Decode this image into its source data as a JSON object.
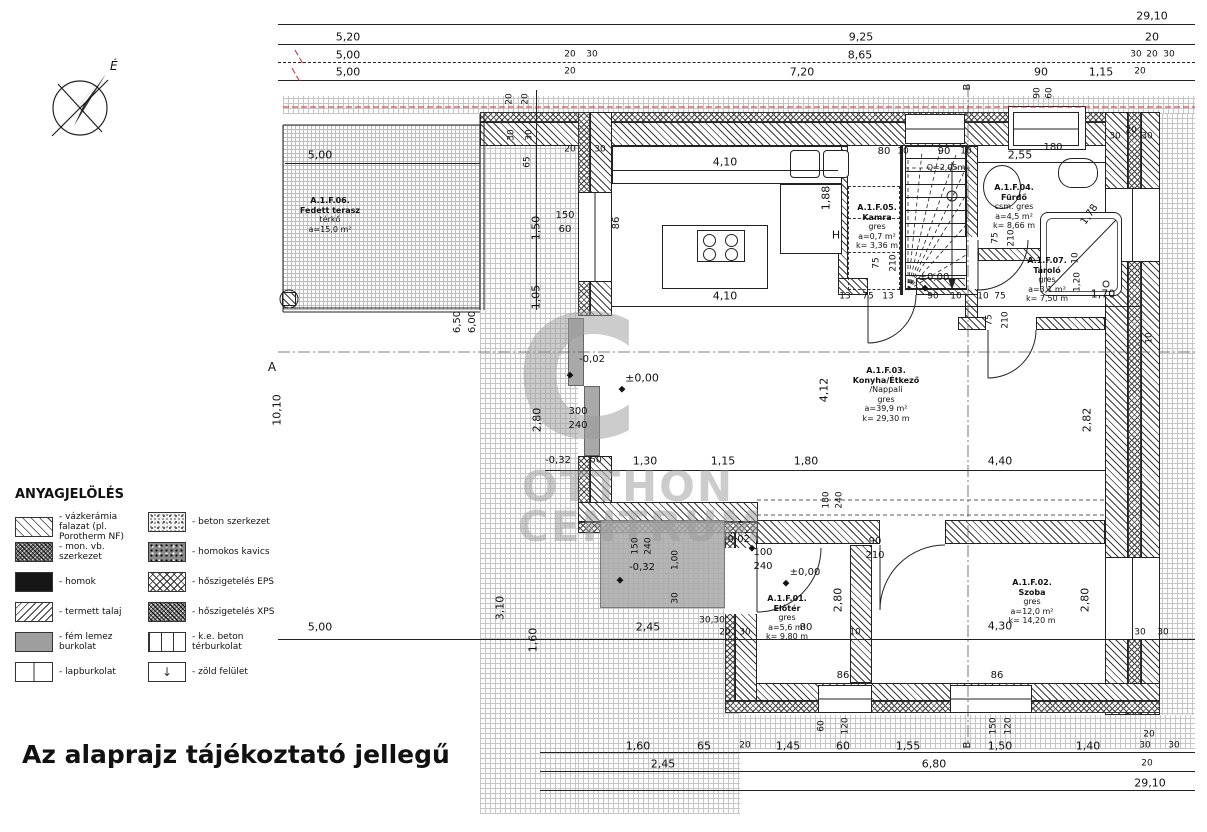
{
  "title": "Az alaprajz tájékoztató jellegű",
  "compass_label": "É",
  "watermark": {
    "big": "C",
    "line1": "OTTHON",
    "line2": "CENTRUM"
  },
  "legend": {
    "title": "ANYAGJELÖLÉS",
    "zold_symbol": "↓",
    "items_left": [
      {
        "pattern": "sw-vazkeramia",
        "label": "- vázkerámia falazat (pl. Porotherm NF)"
      },
      {
        "pattern": "sw-monvb",
        "label": "- mon. vb. szerkezet"
      },
      {
        "pattern": "sw-homok",
        "label": "- homok"
      },
      {
        "pattern": "sw-termett",
        "label": "- termett talaj"
      },
      {
        "pattern": "sw-femlemez",
        "label": "- fém lemez burkolat"
      },
      {
        "pattern": "sw-lap",
        "label": "- lapburkolat"
      }
    ],
    "items_right": [
      {
        "pattern": "sw-beton",
        "label": "- beton szerkezet"
      },
      {
        "pattern": "sw-kavics",
        "label": "- homokos kavics"
      },
      {
        "pattern": "sw-eps",
        "label": "- hőszigetelés EPS"
      },
      {
        "pattern": "sw-xps",
        "label": "- hőszigetelés XPS"
      },
      {
        "pattern": "sw-kebeton",
        "label": "- k.e. beton térburkolat"
      },
      {
        "pattern": "sw-zold",
        "label": "- zöld felület"
      }
    ]
  },
  "rooms": [
    {
      "id": "A1F06",
      "x": 330,
      "y": 196,
      "lines": [
        "A.1.F.06.",
        "Fedett terasz",
        "térkő",
        "a=15,0 m²"
      ]
    },
    {
      "id": "A1F05",
      "x": 877,
      "y": 203,
      "lines": [
        "A.1.F.05.",
        "Kamra",
        "gres",
        "a=0,7 m²",
        "k= 3,36 m"
      ]
    },
    {
      "id": "A1F03",
      "x": 886,
      "y": 366,
      "lines": [
        "A.1.F.03.",
        "Konyha/Étkező",
        "/Nappali",
        "gres",
        "a=39,9 m²",
        "k= 29,30 m"
      ]
    },
    {
      "id": "A1F04",
      "x": 1014,
      "y": 183,
      "lines": [
        "A.1.F.04.",
        "Fürdő",
        "csm. gres",
        "a=4,5 m²",
        "k= 8,66 m"
      ]
    },
    {
      "id": "A1F07",
      "x": 1047,
      "y": 256,
      "lines": [
        "A.1.F.07.",
        "Tároló",
        "gres",
        "a=3,1 m²",
        "k= 7,50 m"
      ]
    },
    {
      "id": "A1F01",
      "x": 787,
      "y": 594,
      "lines": [
        "A.1.F.01.",
        "Előtér",
        "gres",
        "a=5,6 m²",
        "k= 9,80 m"
      ]
    },
    {
      "id": "A1F02",
      "x": 1032,
      "y": 578,
      "lines": [
        "A.1.F.02.",
        "Szoba",
        "gres",
        "a=12,0 m²",
        "k= 14,20 m"
      ]
    }
  ],
  "annotations": [
    {
      "t": "29,10",
      "x": 1152,
      "y": 16
    },
    {
      "t": "5,20",
      "x": 348,
      "y": 37
    },
    {
      "t": "9,25",
      "x": 861,
      "y": 37
    },
    {
      "t": "20",
      "x": 1152,
      "y": 37
    },
    {
      "t": "5,00",
      "x": 348,
      "y": 55
    },
    {
      "t": "20",
      "x": 570,
      "y": 55,
      "s": 9
    },
    {
      "t": "30",
      "x": 592,
      "y": 55,
      "s": 9
    },
    {
      "t": "8,65",
      "x": 860,
      "y": 55
    },
    {
      "t": "30",
      "x": 1136,
      "y": 55,
      "s": 9
    },
    {
      "t": "20",
      "x": 1152,
      "y": 55,
      "s": 9
    },
    {
      "t": "30",
      "x": 1169,
      "y": 55,
      "s": 9
    },
    {
      "t": "5,00",
      "x": 348,
      "y": 72
    },
    {
      "t": "20",
      "x": 570,
      "y": 72,
      "s": 9
    },
    {
      "t": "7,20",
      "x": 802,
      "y": 72
    },
    {
      "t": "90",
      "x": 1041,
      "y": 72
    },
    {
      "t": "1,15",
      "x": 1101,
      "y": 72
    },
    {
      "t": "20",
      "x": 1140,
      "y": 72,
      "s": 9
    },
    {
      "t": "5,00",
      "x": 320,
      "y": 155
    },
    {
      "t": "4,10",
      "x": 725,
      "y": 162
    },
    {
      "t": "4,10",
      "x": 725,
      "y": 296
    },
    {
      "t": "86",
      "x": 617,
      "y": 223,
      "r": -90,
      "s": 10
    },
    {
      "t": "1,88",
      "x": 826,
      "y": 198,
      "r": -90
    },
    {
      "t": "H",
      "x": 836,
      "y": 235,
      "s": 11
    },
    {
      "t": "150",
      "x": 565,
      "y": 216,
      "s": 10
    },
    {
      "t": "60",
      "x": 565,
      "y": 230,
      "s": 10
    },
    {
      "t": "80",
      "x": 884,
      "y": 152,
      "s": 10
    },
    {
      "t": "10",
      "x": 903,
      "y": 152,
      "s": 9
    },
    {
      "t": "90",
      "x": 944,
      "y": 152,
      "s": 10
    },
    {
      "t": "10",
      "x": 966,
      "y": 152,
      "s": 9
    },
    {
      "t": "Q=2,05m",
      "x": 946,
      "y": 168,
      "s": 8
    },
    {
      "t": "75",
      "x": 877,
      "y": 263,
      "r": -90,
      "s": 9
    },
    {
      "t": "210",
      "x": 894,
      "y": 263,
      "r": -90,
      "s": 9
    },
    {
      "t": "±0,00",
      "x": 934,
      "y": 278,
      "s": 10,
      "n": "level-marker"
    },
    {
      "t": "2,55",
      "x": 1020,
      "y": 155
    },
    {
      "t": "180",
      "x": 1053,
      "y": 148,
      "s": 10
    },
    {
      "t": "90",
      "x": 1038,
      "y": 93,
      "r": -90,
      "s": 9
    },
    {
      "t": "60",
      "x": 1050,
      "y": 93,
      "r": -90,
      "s": 9
    },
    {
      "t": "75",
      "x": 996,
      "y": 238,
      "r": -90,
      "s": 9
    },
    {
      "t": "210",
      "x": 1012,
      "y": 238,
      "r": -90,
      "s": 9
    },
    {
      "t": "1,78",
      "x": 1090,
      "y": 215,
      "r": -55,
      "s": 10
    },
    {
      "t": "30",
      "x": 1115,
      "y": 137,
      "s": 9
    },
    {
      "t": "20",
      "x": 1131,
      "y": 131,
      "s": 9
    },
    {
      "t": "30",
      "x": 1147,
      "y": 137,
      "s": 9
    },
    {
      "t": "75",
      "x": 990,
      "y": 320,
      "r": -90,
      "s": 9
    },
    {
      "t": "210",
      "x": 1006,
      "y": 320,
      "r": -90,
      "s": 9
    },
    {
      "t": "1,70",
      "x": 1103,
      "y": 294
    },
    {
      "t": "10",
      "x": 1076,
      "y": 258,
      "r": -90,
      "s": 9
    },
    {
      "t": "1,20",
      "x": 1078,
      "y": 282,
      "r": -90,
      "s": 9
    },
    {
      "t": "10",
      "x": 1150,
      "y": 338,
      "r": -90,
      "s": 9
    },
    {
      "t": "13",
      "x": 845,
      "y": 297,
      "s": 9
    },
    {
      "t": "75",
      "x": 868,
      "y": 297,
      "s": 9
    },
    {
      "t": "13",
      "x": 888,
      "y": 297,
      "s": 9
    },
    {
      "t": "90",
      "x": 933,
      "y": 297,
      "s": 9
    },
    {
      "t": "10",
      "x": 956,
      "y": 297,
      "s": 9
    },
    {
      "t": "10",
      "x": 983,
      "y": 297,
      "s": 9
    },
    {
      "t": "75",
      "x": 1000,
      "y": 297,
      "s": 9
    },
    {
      "t": "20",
      "x": 510,
      "y": 99,
      "r": -90,
      "s": 9
    },
    {
      "t": "20",
      "x": 526,
      "y": 99,
      "r": -90,
      "s": 9
    },
    {
      "t": "30",
      "x": 512,
      "y": 135,
      "r": -90,
      "s": 9
    },
    {
      "t": "30",
      "x": 530,
      "y": 135,
      "r": -90,
      "s": 9
    },
    {
      "t": "20",
      "x": 570,
      "y": 150,
      "s": 9
    },
    {
      "t": "30",
      "x": 600,
      "y": 150,
      "s": 9
    },
    {
      "t": "65",
      "x": 528,
      "y": 162,
      "r": -90,
      "s": 9
    },
    {
      "t": "1,50",
      "x": 536,
      "y": 228,
      "r": -90
    },
    {
      "t": "1,05",
      "x": 536,
      "y": 297,
      "r": -90
    },
    {
      "t": "10,10",
      "x": 277,
      "y": 410,
      "r": -90
    },
    {
      "t": "6,50",
      "x": 458,
      "y": 322,
      "r": -90,
      "s": 10
    },
    {
      "t": "6,00",
      "x": 473,
      "y": 322,
      "r": -90,
      "s": 10
    },
    {
      "t": "2,80",
      "x": 537,
      "y": 420,
      "r": -90
    },
    {
      "t": "-0,02",
      "x": 592,
      "y": 360,
      "s": 10,
      "n": "level-marker"
    },
    {
      "t": "±0,00",
      "x": 642,
      "y": 378,
      "s": 11,
      "n": "level-marker"
    },
    {
      "t": "300",
      "x": 578,
      "y": 412,
      "s": 10
    },
    {
      "t": "240",
      "x": 578,
      "y": 426,
      "s": 10
    },
    {
      "t": "-0,32",
      "x": 558,
      "y": 461,
      "s": 10
    },
    {
      "t": "50",
      "x": 596,
      "y": 461,
      "s": 9
    },
    {
      "t": "1,30",
      "x": 645,
      "y": 461
    },
    {
      "t": "1,15",
      "x": 723,
      "y": 461
    },
    {
      "t": "1,80",
      "x": 806,
      "y": 461
    },
    {
      "t": "4,40",
      "x": 1000,
      "y": 461
    },
    {
      "t": "4,12",
      "x": 824,
      "y": 390,
      "r": -90
    },
    {
      "t": "2,82",
      "x": 1087,
      "y": 420,
      "r": -90
    },
    {
      "t": "150",
      "x": 636,
      "y": 546,
      "r": -90,
      "s": 9
    },
    {
      "t": "240",
      "x": 649,
      "y": 546,
      "r": -90,
      "s": 9
    },
    {
      "t": "1,00",
      "x": 676,
      "y": 560,
      "r": -90,
      "s": 9
    },
    {
      "t": "30",
      "x": 676,
      "y": 598,
      "r": -90,
      "s": 9
    },
    {
      "t": "-0,32",
      "x": 642,
      "y": 568,
      "s": 10,
      "n": "level-marker"
    },
    {
      "t": "-0,02",
      "x": 737,
      "y": 540,
      "s": 10,
      "n": "level-marker"
    },
    {
      "t": "100",
      "x": 763,
      "y": 553,
      "s": 10
    },
    {
      "t": "240",
      "x": 763,
      "y": 567,
      "s": 10
    },
    {
      "t": "±0,00",
      "x": 805,
      "y": 573,
      "s": 10,
      "n": "level-marker"
    },
    {
      "t": "180",
      "x": 827,
      "y": 500,
      "r": -90,
      "s": 9
    },
    {
      "t": "240",
      "x": 840,
      "y": 500,
      "r": -90,
      "s": 9
    },
    {
      "t": "90",
      "x": 875,
      "y": 542,
      "s": 10
    },
    {
      "t": "210",
      "x": 875,
      "y": 556,
      "s": 10
    },
    {
      "t": "2,80",
      "x": 838,
      "y": 600,
      "r": -90
    },
    {
      "t": "2,80",
      "x": 1085,
      "y": 600,
      "r": -90
    },
    {
      "t": "5,00",
      "x": 320,
      "y": 627
    },
    {
      "t": "3,10",
      "x": 500,
      "y": 608,
      "r": -90
    },
    {
      "t": "1,60",
      "x": 533,
      "y": 640,
      "r": -90
    },
    {
      "t": "2,45",
      "x": 648,
      "y": 627
    },
    {
      "t": "30,30",
      "x": 712,
      "y": 621,
      "s": 9
    },
    {
      "t": "20",
      "x": 725,
      "y": 633,
      "s": 9
    },
    {
      "t": "30",
      "x": 745,
      "y": 633,
      "s": 9
    },
    {
      "t": "80",
      "x": 806,
      "y": 628,
      "s": 10
    },
    {
      "t": "10",
      "x": 855,
      "y": 633,
      "s": 9
    },
    {
      "t": "4,30",
      "x": 1000,
      "y": 626
    },
    {
      "t": "30",
      "x": 1140,
      "y": 633,
      "s": 9
    },
    {
      "t": "30",
      "x": 1163,
      "y": 633,
      "s": 9
    },
    {
      "t": "86",
      "x": 843,
      "y": 676,
      "s": 10
    },
    {
      "t": "60",
      "x": 822,
      "y": 726,
      "r": -90,
      "s": 9
    },
    {
      "t": "120",
      "x": 846,
      "y": 726,
      "r": -90,
      "s": 9
    },
    {
      "t": "86",
      "x": 997,
      "y": 676,
      "s": 10
    },
    {
      "t": "150",
      "x": 994,
      "y": 726,
      "r": -90,
      "s": 9
    },
    {
      "t": "120",
      "x": 1009,
      "y": 726,
      "r": -90,
      "s": 9
    },
    {
      "t": "1,60",
      "x": 638,
      "y": 746
    },
    {
      "t": "65",
      "x": 704,
      "y": 746
    },
    {
      "t": "20",
      "x": 745,
      "y": 746,
      "s": 9
    },
    {
      "t": "1,45",
      "x": 788,
      "y": 746
    },
    {
      "t": "60",
      "x": 843,
      "y": 746
    },
    {
      "t": "1,55",
      "x": 908,
      "y": 746
    },
    {
      "t": "1,50",
      "x": 1000,
      "y": 746
    },
    {
      "t": "1,40",
      "x": 1088,
      "y": 746
    },
    {
      "t": "30",
      "x": 1145,
      "y": 746,
      "s": 9
    },
    {
      "t": "30",
      "x": 1174,
      "y": 746,
      "s": 9
    },
    {
      "t": "20",
      "x": 1149,
      "y": 735,
      "s": 9
    },
    {
      "t": "2,45",
      "x": 663,
      "y": 764
    },
    {
      "t": "6,80",
      "x": 934,
      "y": 764
    },
    {
      "t": "20",
      "x": 1147,
      "y": 764,
      "s": 9
    },
    {
      "t": "29,10",
      "x": 1150,
      "y": 783
    },
    {
      "t": "A",
      "x": 272,
      "y": 367,
      "s": 12,
      "n": "section-label"
    },
    {
      "t": "B",
      "x": 968,
      "y": 87,
      "r": -90,
      "s": 10,
      "n": "section-label"
    },
    {
      "t": "B",
      "x": 968,
      "y": 745,
      "r": -90,
      "s": 10,
      "n": "section-label"
    },
    {
      "t": "◆",
      "x": 570,
      "y": 376,
      "s": 9,
      "n": "level-marker-icon"
    },
    {
      "t": "◆",
      "x": 622,
      "y": 390,
      "s": 9,
      "n": "level-marker-icon"
    },
    {
      "t": "◆",
      "x": 925,
      "y": 289,
      "s": 9,
      "n": "level-marker-icon"
    },
    {
      "t": "◆",
      "x": 752,
      "y": 549,
      "s": 9,
      "n": "level-marker-icon"
    },
    {
      "t": "◆",
      "x": 786,
      "y": 584,
      "s": 9,
      "n": "level-marker-icon"
    },
    {
      "t": "◆",
      "x": 620,
      "y": 581,
      "s": 9,
      "n": "level-marker-icon"
    }
  ]
}
